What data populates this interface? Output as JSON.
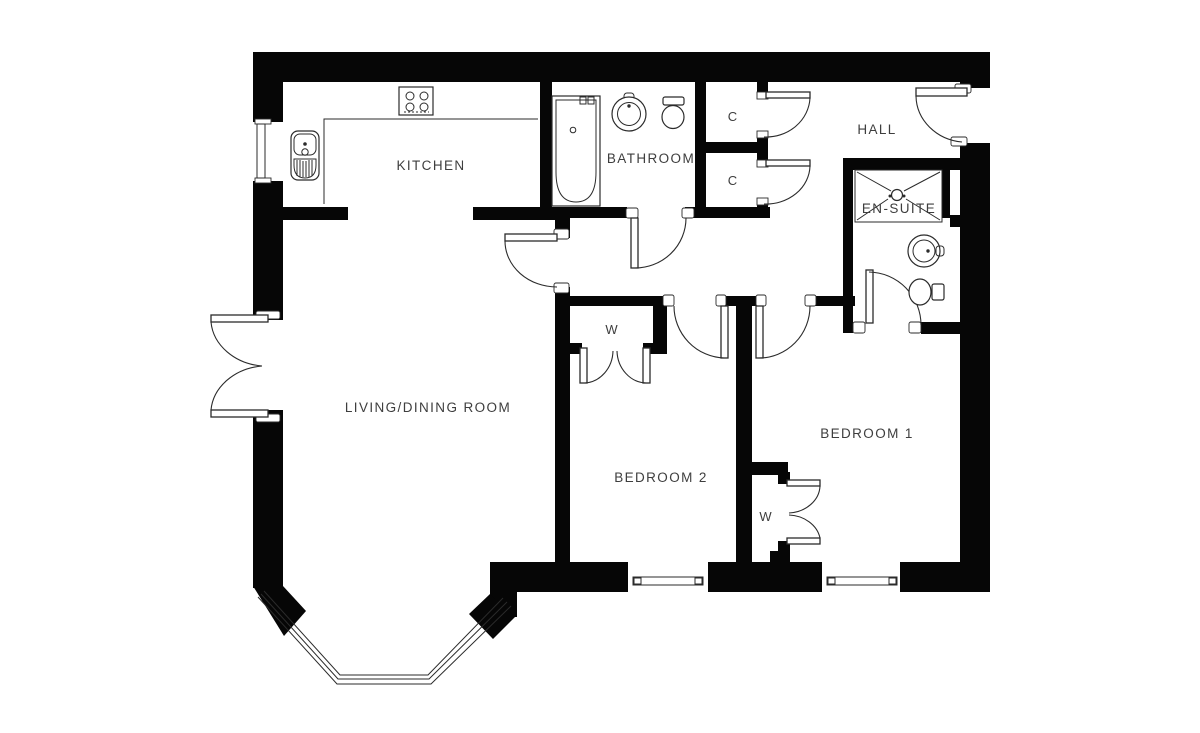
{
  "floorplan": {
    "description": "Two-bedroom apartment floor plan, black walls on white background",
    "colors": {
      "wall": "#060606",
      "line": "#2b2b2b",
      "text": "#3e3e3e",
      "bg": "#ffffff"
    },
    "rooms": {
      "kitchen": {
        "label": "KITCHEN"
      },
      "bathroom": {
        "label": "BATHROOM"
      },
      "hall": {
        "label": "HALL"
      },
      "closet_upper": {
        "label": "C"
      },
      "closet_lower": {
        "label": "C"
      },
      "ensuite": {
        "label": "EN-SUITE"
      },
      "living_dining": {
        "label": "LIVING/DINING ROOM"
      },
      "bedroom_2": {
        "label": "BEDROOM 2"
      },
      "bedroom_1": {
        "label": "BEDROOM 1"
      },
      "wardrobe_bedroom_2": {
        "label": "W"
      },
      "wardrobe_bedroom_1": {
        "label": "W"
      }
    },
    "fixtures": {
      "kitchen": [
        "hob-icon",
        "sink-drainer-icon",
        "worktop-counter"
      ],
      "bathroom": [
        "bathtub-icon",
        "washbasin-icon",
        "toilet-icon"
      ],
      "ensuite": [
        "shower-icon",
        "washbasin-icon",
        "toilet-icon"
      ]
    },
    "features": [
      "bay-window",
      "french-doors",
      "entrance-door",
      "double-wardrobes",
      "hall-closets"
    ]
  }
}
